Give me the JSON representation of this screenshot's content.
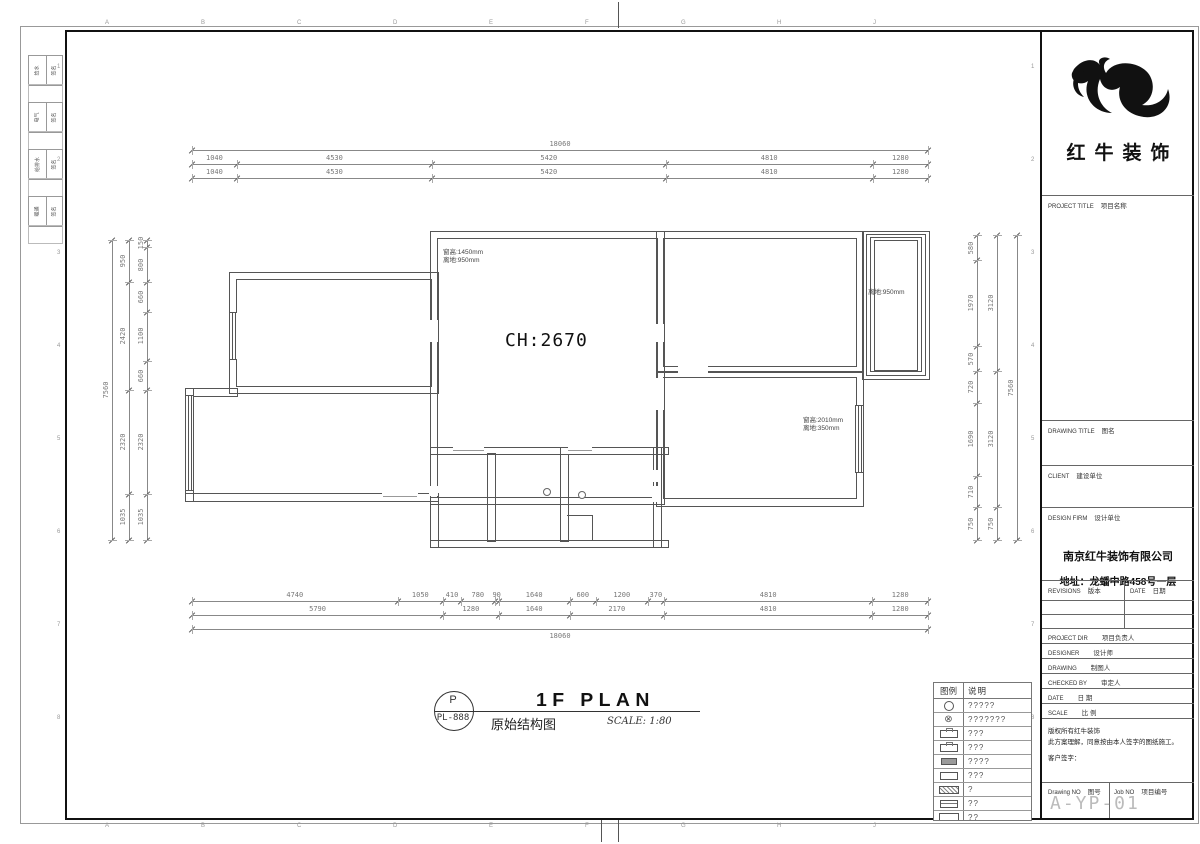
{
  "sheet": {
    "grid_letters": [
      "A",
      "B",
      "C",
      "D",
      "E",
      "F",
      "G",
      "H",
      "J"
    ],
    "grid_numbers": [
      "1",
      "2",
      "3",
      "4",
      "5",
      "6",
      "7",
      "8"
    ]
  },
  "signature_strip": {
    "groups": [
      {
        "label": "给水",
        "sign": "签名"
      },
      {
        "label": "电气",
        "sign": "签名"
      },
      {
        "label": "给排水",
        "sign": "签名"
      },
      {
        "label": "暖通",
        "sign": "签名"
      }
    ]
  },
  "plan": {
    "ch_label": "CH:2670",
    "window_labels": [
      {
        "x": 443,
        "y": 249,
        "lines": [
          "窗高:1450mm",
          "离地:950mm"
        ]
      },
      {
        "x": 868,
        "y": 289,
        "lines": [
          "离地:950mm"
        ]
      },
      {
        "x": 803,
        "y": 417,
        "lines": [
          "窗高:2010mm",
          "离地:350mm"
        ]
      }
    ]
  },
  "dimensions": {
    "top": [
      {
        "pos": 150,
        "start": 192,
        "end": 928,
        "values": [
          "18060"
        ]
      },
      {
        "pos": 164,
        "start": 192,
        "end": 928,
        "values": [
          "1040",
          "4530",
          "5420",
          "4810",
          "1280"
        ]
      },
      {
        "pos": 178,
        "start": 192,
        "end": 928,
        "values": [
          "1040",
          "4530",
          "5420",
          "4810",
          "1280"
        ]
      }
    ],
    "bottom": [
      {
        "pos": 601,
        "start": 192,
        "end": 928,
        "values": [
          "4740",
          "1050",
          "410",
          "780",
          "90",
          "1640",
          "600",
          "1200",
          "370",
          "4810",
          "1280"
        ]
      },
      {
        "pos": 615,
        "start": 192,
        "end": 928,
        "values": [
          "5790",
          "1280",
          "1640",
          "2170",
          "4810",
          "1280"
        ]
      },
      {
        "pos": 629,
        "start": 192,
        "end": 928,
        "values": [
          "18060"
        ],
        "labelBelow": true
      }
    ],
    "left": [
      {
        "pos": 112,
        "start": 240,
        "end": 540,
        "values": [
          "7560"
        ]
      },
      {
        "pos": 129,
        "start": 240,
        "end": 540,
        "values": [
          "950",
          "2420",
          "2320",
          "1035"
        ]
      },
      {
        "pos": 147,
        "start": 240,
        "end": 540,
        "values": [
          "150",
          "800",
          "660",
          "1100",
          "660",
          "2320",
          "1035"
        ]
      }
    ],
    "right": [
      {
        "pos": 977,
        "start": 235,
        "end": 540,
        "values": [
          "580",
          "1970",
          "570",
          "720",
          "1690",
          "710",
          "750"
        ]
      },
      {
        "pos": 997,
        "start": 235,
        "end": 540,
        "values": [
          "3120",
          "3120",
          "750"
        ]
      },
      {
        "pos": 1017,
        "start": 235,
        "end": 540,
        "values": [
          "7560"
        ]
      }
    ]
  },
  "footer": {
    "tag_letter": "P",
    "tag_code": "PL-888",
    "title_en": "1F PLAN",
    "title_cn": "原始结构图",
    "scale_text": "SCALE: 1:80"
  },
  "legend": {
    "header_symbol": "图例",
    "header_desc": "说明",
    "rows": [
      {
        "symbol": "s-circle",
        "desc": "?????"
      },
      {
        "symbol": "s-circle-x",
        "desc": "???????"
      },
      {
        "symbol": "s-pbox",
        "desc": "???"
      },
      {
        "symbol": "s-pbox",
        "desc": "???"
      },
      {
        "symbol": "s-fill",
        "desc": "????"
      },
      {
        "symbol": "s-box",
        "desc": "???"
      },
      {
        "symbol": "s-hatch",
        "desc": "?"
      },
      {
        "symbol": "s-lined",
        "desc": "??"
      },
      {
        "symbol": "s-wide",
        "desc": "??"
      },
      {
        "symbol": "s-dot",
        "desc": "????"
      }
    ]
  },
  "title_block": {
    "logo_name": "红牛装饰",
    "project_title": {
      "en": "PROJECT TITLE",
      "cn": "项目名称"
    },
    "drawing_title": {
      "en": "DRAWING TITLE",
      "cn": "图名"
    },
    "client": {
      "en": "CLIENT",
      "cn": "建设单位"
    },
    "design_firm": {
      "en": "DESIGN FIRM",
      "cn": "设计单位"
    },
    "firm_name": "南京红牛装饰有限公司",
    "firm_address": "地址：龙蟠中路458号一层",
    "revisions": {
      "en": "REVISIONS",
      "cn": "版本"
    },
    "date_col": {
      "en": "DATE",
      "cn": "日期"
    },
    "rows": [
      {
        "en": "PROJECT DIR",
        "cn": "项目负责人"
      },
      {
        "en": "DESIGNER",
        "cn": "设计师"
      },
      {
        "en": "DRAWING",
        "cn": "制图人"
      },
      {
        "en": "CHECKED BY",
        "cn": "审定人"
      },
      {
        "en": "DATE",
        "cn": "日  期"
      },
      {
        "en": "SCALE",
        "cn": "比  例"
      }
    ],
    "notes": [
      "版权所有红牛装饰",
      "此方案理解，同意按由本人签字的图纸施工。",
      "客户签字："
    ],
    "drawing_no": {
      "en": "Drawing NO",
      "cn": "图号"
    },
    "job_no": {
      "en": "Job NO",
      "cn": "项目编号"
    },
    "sheet_code": "A-YP-01"
  }
}
